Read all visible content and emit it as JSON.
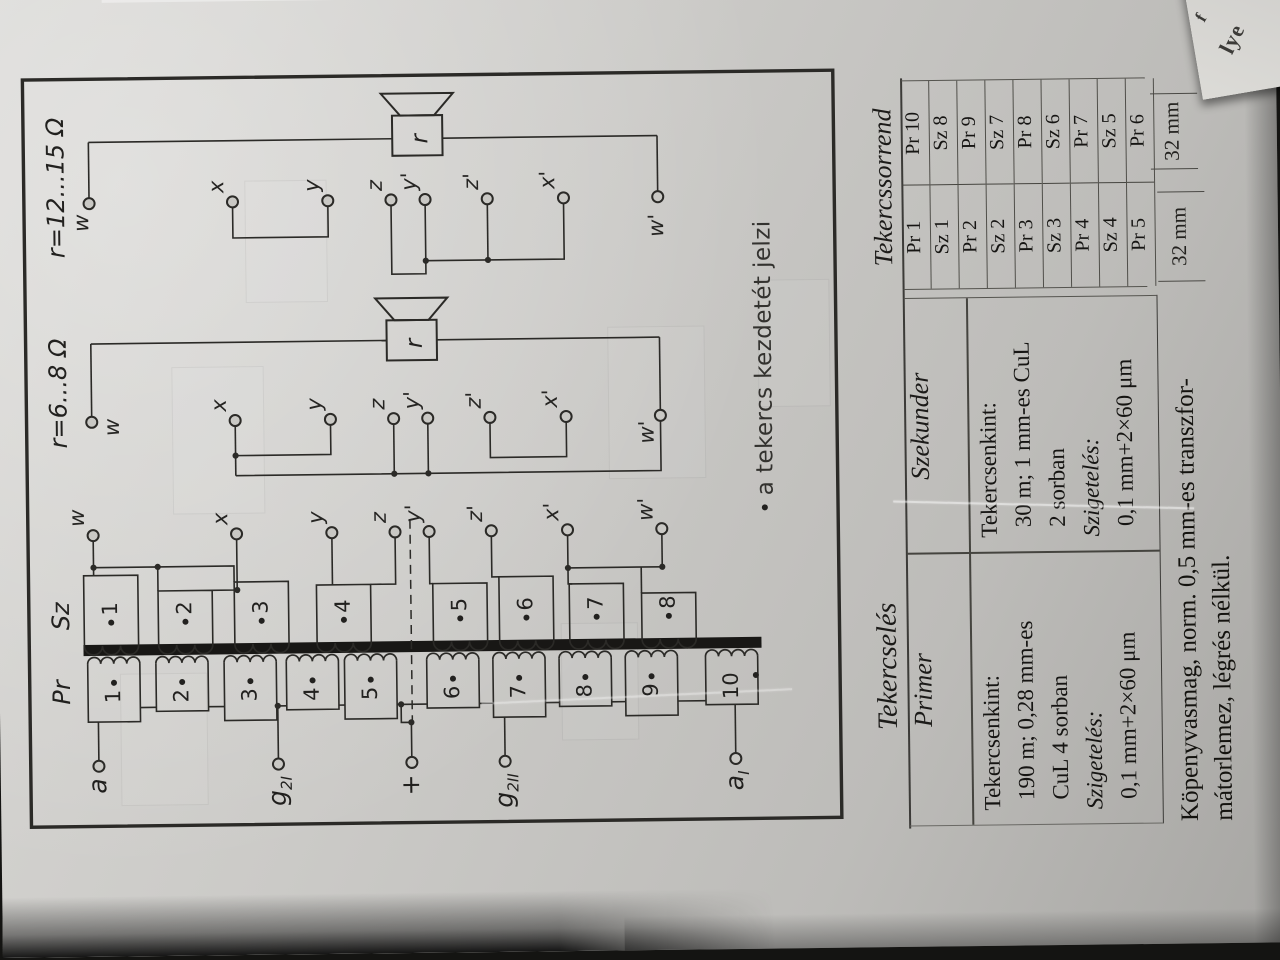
{
  "diagram": {
    "pr_col_label": "Pr",
    "sz_col_label": "Sz",
    "impedance_label_left": "r=6...8 Ω",
    "impedance_label_right": "r=12...15 Ω",
    "speaker_label": "r",
    "inputs": [
      {
        "main": "a",
        "sub": ""
      },
      {
        "main": "g",
        "sub": "2I"
      },
      {
        "main": "+",
        "sub": ""
      },
      {
        "main": "g",
        "sub": "2II"
      },
      {
        "main": "a",
        "sub": "I"
      }
    ],
    "pr_numbers": [
      "1",
      "2",
      "3",
      "4",
      "5",
      "6",
      "7",
      "8",
      "9",
      "10"
    ],
    "sz_numbers": [
      "1",
      "2",
      "3",
      "4",
      "5",
      "6",
      "7",
      "8"
    ],
    "tap_labels": [
      "w",
      "x",
      "y",
      "z",
      "y'",
      "z'",
      "x'",
      "w'"
    ],
    "note_marker": "•",
    "note": "a tekercs kezdetét jelzi"
  },
  "winding_table": {
    "title": "Tekercselés",
    "columns": [
      "Primer",
      "Szekunder"
    ],
    "primer_lines": [
      "Tekercsenkint:",
      "190 m; 0,28 mm-es",
      "CuL 4 sorban",
      "Szigetelés:",
      "0,1 mm+2×60 μm"
    ],
    "szekunder_lines": [
      "Tekercsenkint:",
      "30 m; 1 mm-es CuL",
      "2 sorban",
      "Szigetelés:",
      "0,1 mm+2×60 μm"
    ]
  },
  "order_table": {
    "title": "Tekercssorrend",
    "col1": [
      "Pr 1",
      "Sz 1",
      "Pr 2",
      "Sz 2",
      "Pr 3",
      "Sz 3",
      "Pr 4",
      "Sz 4",
      "Pr 5"
    ],
    "col2": [
      "Pr 10",
      "Sz 8",
      "Pr 9",
      "Sz 7",
      "Pr 8",
      "Sz 6",
      "Pr 7",
      "Sz 5",
      "Pr 6"
    ],
    "dims": [
      "32 mm",
      "32 mm"
    ]
  },
  "footnote": [
    "Köpenyvasmag, norm. 0,5 mm-es transzfor-",
    "mátorlemez, légrés nélkül."
  ],
  "edge_fragments": [
    "f",
    "lye"
  ]
}
